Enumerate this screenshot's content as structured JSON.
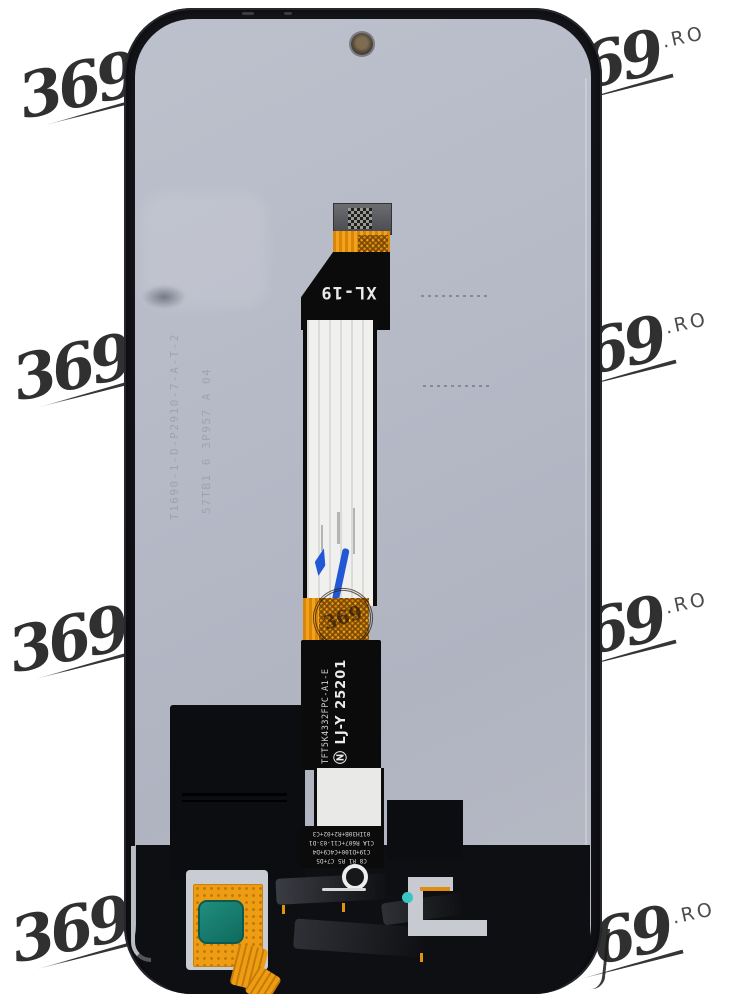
{
  "photo": {
    "subject": "Phone LCD display assembly, back side with flex cable"
  },
  "watermarks": {
    "items": [
      {
        "text": "369",
        "suffix": "",
        "position": "top-left"
      },
      {
        "text": "369",
        "suffix": ".RO",
        "position": "top-right"
      },
      {
        "text": "369",
        "suffix": "",
        "position": "middle-left"
      },
      {
        "text": "369",
        "suffix": ".RO",
        "position": "middle-right"
      },
      {
        "text": "369",
        "suffix": "",
        "position": "lower-left"
      },
      {
        "text": "369",
        "suffix": ".RO",
        "position": "lower-right"
      },
      {
        "text": "369",
        "suffix": "",
        "position": "bottom-left"
      },
      {
        "text": "369",
        "suffix": ".RO",
        "position": "bottom-right"
      }
    ]
  },
  "device": {
    "flex_top_label": "XL-19",
    "flex_part_number": "TFT5K4332FPC-A1-E",
    "flex_symbol": "Ⓝ",
    "flex_lot": "LJ-Y 25201",
    "etched_col1": "T1690-1-D-P2910-7-A-T-2",
    "etched_col2": "57TB1 6 3P957 A 04",
    "stamp_text": "369",
    "silkscreen_lines": [
      "C8 R1 R5 C7+D5",
      "C19+D100+C4C9+D4",
      "C1A R607+C11-03-D1",
      "01IH30B+R2+02+C3"
    ]
  },
  "colors": {
    "kapton_orange": "#ef9c15",
    "teal_sticker": "#1b8274",
    "teal_dot": "#38c6c4",
    "marker_blue": "#2257d6",
    "panel_gray": "#b6bac7",
    "watermark_ink": "#1f1f1f"
  }
}
